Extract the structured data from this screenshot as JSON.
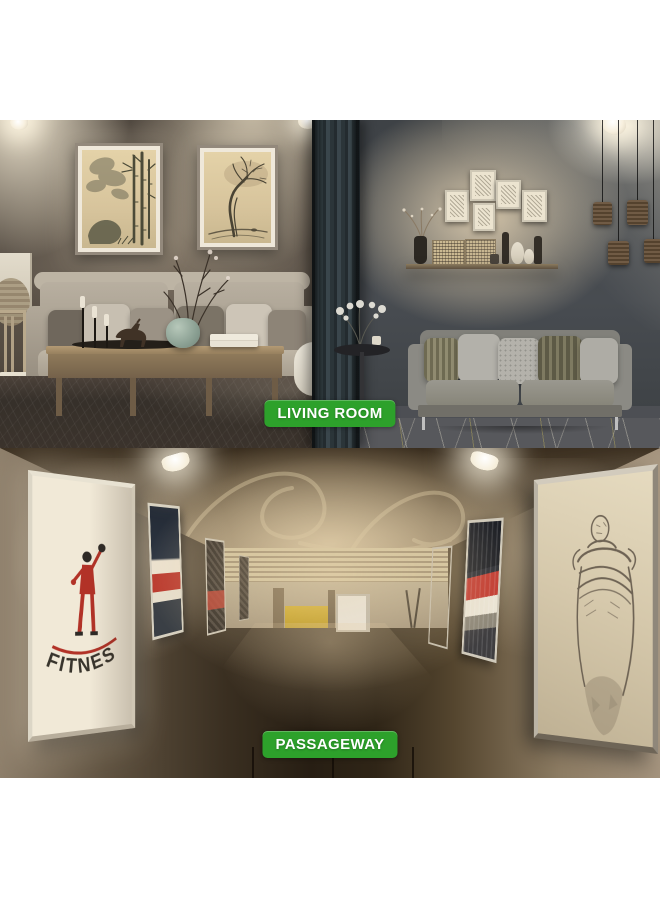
{
  "scenes": {
    "living_room": {
      "badge": "LIVING ROOM"
    },
    "passageway": {
      "badge": "PASSAGEWAY",
      "fitness_poster_text": "FITNESS"
    }
  },
  "colors": {
    "badge_background": "#2da12b",
    "badge_text": "#ffffff",
    "fitness_red": "#b23227",
    "poster_stripe_red": "#c23a30"
  }
}
